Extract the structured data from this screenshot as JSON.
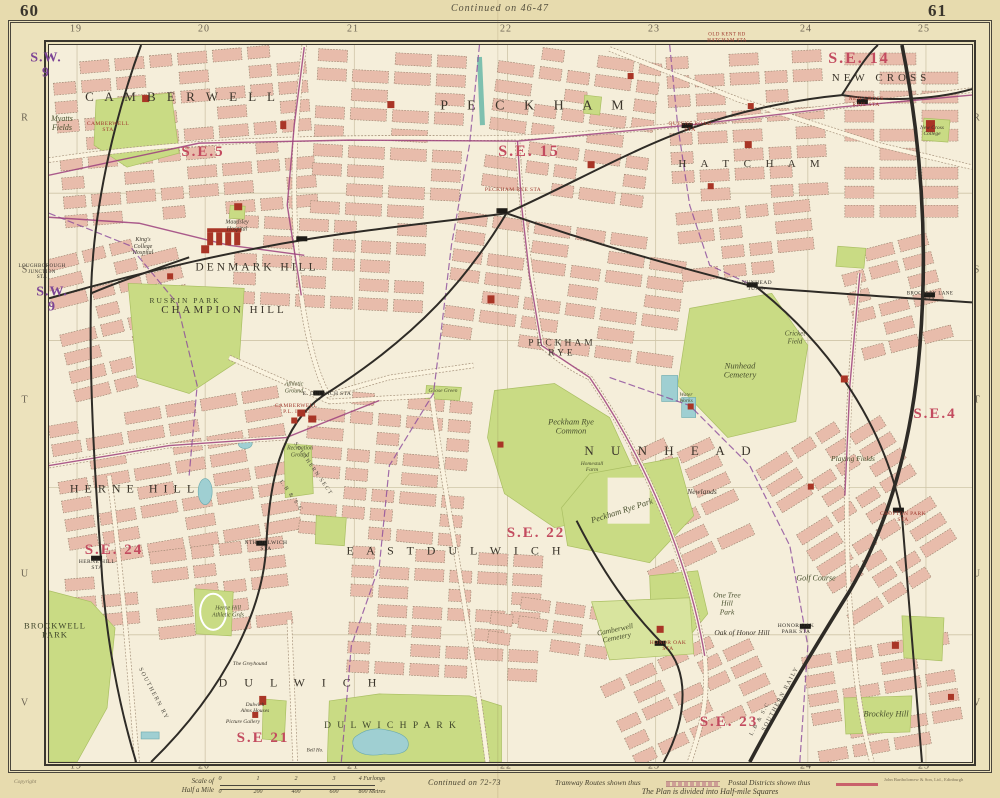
{
  "page": {
    "left_page_no": "60",
    "right_page_no": "61",
    "continued_top": "Continued on  46-47",
    "continued_bottom": "Continued on  72-73",
    "copyright": "Copyright",
    "imprint": "John Bartholomew & Son, Ltd., Edinburgh"
  },
  "grid": {
    "top_numbers": [
      "19",
      "20",
      "21",
      "22",
      "23",
      "24",
      "25"
    ],
    "bottom_numbers": [
      "19",
      "20",
      "21",
      "22",
      "23",
      "24",
      "25"
    ],
    "left_letters": [
      "R",
      "S",
      "T",
      "U",
      "V"
    ],
    "right_letters": [
      "R",
      "S",
      "T",
      "U",
      "V"
    ]
  },
  "legend": {
    "scale_line1": "Scale of",
    "scale_line2": "Half a Mile",
    "furlong_ticks": [
      "0",
      "1",
      "2",
      "3",
      "4 Furlongs"
    ],
    "metre_ticks": [
      "0",
      "200",
      "400",
      "600",
      "800 Metres"
    ],
    "tramway_label": "Tramway Routes shown thus",
    "postal_label": "Postal Districts shown thus",
    "plan_note": "The Plan is divided into Half-mile Squares"
  },
  "colors": {
    "page_bg": "#e7dbae",
    "margin_bg": "#ece2bc",
    "map_bg": "#f5eeda",
    "block": "#e8bcab",
    "block_edge": "#917e68",
    "park": "#c9db84",
    "park_dark": "#aabf63",
    "water": "#9fcfd2",
    "canal": "#7ec0af",
    "rail": "#2e2b26",
    "road": "#faf3df",
    "road_edge": "#a5917a",
    "tram": "#9c3f7d",
    "boundary": "#8b4a9b",
    "postal": "#c34b5f",
    "postal_purple": "#7d4596",
    "red_bldg": "#a93526",
    "district_ink": "#3b352b",
    "sta_red": "#9e372c",
    "frame": "#3a362e",
    "grid": "#cfc5a8",
    "edge_ink": "#6b6353"
  },
  "map_labels": [
    {
      "t": "C A M B E R W E L L",
      "x": 182,
      "y": 97,
      "c": "district",
      "s": 13,
      "ls": 4
    },
    {
      "t": "P E C K H A M",
      "x": 536,
      "y": 106,
      "c": "district",
      "s": 14,
      "ls": 8
    },
    {
      "t": "H A T C H A M",
      "x": 752,
      "y": 164,
      "c": "district",
      "s": 11,
      "ls": 6
    },
    {
      "t": "NEW CROSS",
      "x": 881,
      "y": 78,
      "c": "district",
      "s": 11,
      "ls": 4
    },
    {
      "t": "DENMARK HILL",
      "x": 257,
      "y": 268,
      "c": "district",
      "s": 11.5,
      "ls": 3
    },
    {
      "t": "CHAMPION HILL",
      "x": 224,
      "y": 310,
      "c": "district",
      "s": 11,
      "ls": 3
    },
    {
      "t": "HERNE  HILL",
      "x": 135,
      "y": 489,
      "c": "district",
      "s": 12,
      "ls": 6
    },
    {
      "t": "E A S T   D U L W I C H",
      "x": 456,
      "y": 551,
      "c": "district",
      "s": 12,
      "ls": 5
    },
    {
      "t": "D U L W I C H",
      "x": 301,
      "y": 683,
      "c": "district",
      "s": 12,
      "ls": 7
    },
    {
      "t": "N U N H E A D",
      "x": 671,
      "y": 451,
      "c": "district",
      "s": 13,
      "ls": 7
    },
    {
      "t": "PECKHAM\nRYE",
      "x": 562,
      "y": 349,
      "c": "district",
      "s": 9.5,
      "ls": 3
    },
    {
      "t": "S.E.5",
      "x": 203,
      "y": 152,
      "c": "postal",
      "s": 15
    },
    {
      "t": "S.E. 15",
      "x": 529,
      "y": 152,
      "c": "postal",
      "s": 16
    },
    {
      "t": "S.E. 14",
      "x": 859,
      "y": 59,
      "c": "postal",
      "s": 16
    },
    {
      "t": "S.E.4",
      "x": 935,
      "y": 414,
      "c": "postal",
      "s": 15
    },
    {
      "t": "S.E. 24",
      "x": 114,
      "y": 550,
      "c": "postal",
      "s": 15
    },
    {
      "t": "S.E. 22",
      "x": 536,
      "y": 533,
      "c": "postal",
      "s": 15
    },
    {
      "t": "S.E 21",
      "x": 263,
      "y": 738,
      "c": "postal",
      "s": 15
    },
    {
      "t": "S.E. 23",
      "x": 729,
      "y": 722,
      "c": "postal",
      "s": 15
    },
    {
      "t": "S.W.\n9",
      "x": 46,
      "y": 66,
      "c": "postal-p",
      "s": 14
    },
    {
      "t": "S.W.\n9",
      "x": 52,
      "y": 300,
      "c": "postal-p",
      "s": 14
    },
    {
      "t": "RUSKIN PARK",
      "x": 185,
      "y": 301,
      "c": "park-caps",
      "s": 7.5,
      "ls": 2
    },
    {
      "t": "BROCKWELL\nPARK",
      "x": 55,
      "y": 631,
      "c": "park-caps",
      "s": 8.5,
      "ls": 1
    },
    {
      "t": "D U L W I C H   P A R K",
      "x": 391,
      "y": 726,
      "c": "park-caps",
      "s": 9.5,
      "ls": 2
    },
    {
      "t": "Myatts\nFields",
      "x": 62,
      "y": 124,
      "c": "park",
      "s": 8
    },
    {
      "t": "Peckham Rye\nCommon",
      "x": 571,
      "y": 427,
      "c": "park",
      "s": 8.5
    },
    {
      "t": "Peckham Rye Park",
      "x": 622,
      "y": 511,
      "c": "park",
      "s": 8.5,
      "r": -18
    },
    {
      "t": "Nunhead\nCemetery",
      "x": 740,
      "y": 371,
      "c": "park",
      "s": 8.5
    },
    {
      "t": "One Tree\nHill\nPark",
      "x": 727,
      "y": 604,
      "c": "park",
      "s": 7.5
    },
    {
      "t": "Golf Course",
      "x": 816,
      "y": 579,
      "c": "park",
      "s": 8
    },
    {
      "t": "Camberwell\nCemetery",
      "x": 616,
      "y": 634,
      "c": "park",
      "s": 7.5,
      "r": -12
    },
    {
      "t": "Brockley Hill",
      "x": 886,
      "y": 714,
      "c": "park",
      "s": 8.5
    },
    {
      "t": "Playing Fields",
      "x": 853,
      "y": 459,
      "c": "park",
      "s": 7.5
    },
    {
      "t": "Cricket\nField",
      "x": 795,
      "y": 338,
      "c": "park",
      "s": 7
    },
    {
      "t": "Water\nWorks",
      "x": 686,
      "y": 398,
      "c": "park",
      "s": 5.5
    },
    {
      "t": "Homestall\nFarm",
      "x": 592,
      "y": 467,
      "c": "park",
      "s": 5.5
    },
    {
      "t": "Goose Green",
      "x": 443,
      "y": 391,
      "c": "park",
      "s": 5.5
    },
    {
      "t": "Athletic\nGround",
      "x": 294,
      "y": 388,
      "c": "park",
      "s": 6
    },
    {
      "t": "Recreation\nGround",
      "x": 300,
      "y": 452,
      "c": "park",
      "s": 6
    },
    {
      "t": "Herne Hill\nAthletic Grds",
      "x": 228,
      "y": 612,
      "c": "park",
      "s": 6
    },
    {
      "t": "Oak of Honor Hill",
      "x": 742,
      "y": 633,
      "c": "place",
      "s": 7.5
    },
    {
      "t": "Newlands",
      "x": 702,
      "y": 492,
      "c": "place",
      "s": 7.5
    },
    {
      "t": "King's\nCollege\nHospital",
      "x": 143,
      "y": 247,
      "c": "place",
      "s": 6
    },
    {
      "t": "Maudsley\nHospital",
      "x": 237,
      "y": 226,
      "c": "place",
      "s": 6
    },
    {
      "t": "Dulwich\nAlms Houses",
      "x": 255,
      "y": 708,
      "c": "place",
      "s": 5.5
    },
    {
      "t": "Picture Gallery",
      "x": 243,
      "y": 722,
      "c": "place",
      "s": 5.5
    },
    {
      "t": "The Greyhound",
      "x": 250,
      "y": 664,
      "c": "place",
      "s": 5.5
    },
    {
      "t": "Bell Ho.",
      "x": 315,
      "y": 751,
      "c": "place",
      "s": 5
    },
    {
      "t": "New Cross\nCollege",
      "x": 932,
      "y": 131,
      "c": "place",
      "s": 5.5
    },
    {
      "t": "CAMBERWELL\nSTA",
      "x": 108,
      "y": 127,
      "c": "sta",
      "s": 5.5
    },
    {
      "t": "PECKHAM RYE STA",
      "x": 513,
      "y": 190,
      "c": "sta",
      "s": 5.5
    },
    {
      "t": "QUEENS ROAD\nSTA",
      "x": 690,
      "y": 127,
      "c": "sta",
      "s": 5.5
    },
    {
      "t": "NEW CROSS\nRAIL STA",
      "x": 866,
      "y": 102,
      "c": "sta",
      "s": 5.5
    },
    {
      "t": "OLD KENT RD\nHATCHAM STA",
      "x": 727,
      "y": 38,
      "c": "sta",
      "s": 5
    },
    {
      "t": "CROFTON PARK\nSTA",
      "x": 903,
      "y": 517,
      "c": "sta",
      "s": 5.5
    },
    {
      "t": "HONOR OAK\nSTA",
      "x": 668,
      "y": 646,
      "c": "sta",
      "s": 5.5
    },
    {
      "t": "CAMBERWELL\nP.L. INST",
      "x": 296,
      "y": 409,
      "c": "sta",
      "s": 5.5
    },
    {
      "t": "LOUGHBOROUGH\nJUNCTION\nSTA",
      "x": 42,
      "y": 272,
      "c": "sta-k",
      "s": 5
    },
    {
      "t": "NUNHEAD\nJUNC.",
      "x": 757,
      "y": 286,
      "c": "sta-k",
      "s": 5.5
    },
    {
      "t": "BROCKLEY LANE\nSTA",
      "x": 930,
      "y": 297,
      "c": "sta-k",
      "s": 5
    },
    {
      "t": "HERNE HILL\nSTA",
      "x": 97,
      "y": 565,
      "c": "sta-k",
      "s": 5.5
    },
    {
      "t": "NTH DULWICH\nSTA",
      "x": 266,
      "y": 546,
      "c": "sta-k",
      "s": 5.5
    },
    {
      "t": "E. DULWICH STA",
      "x": 327,
      "y": 394,
      "c": "sta-k",
      "s": 5.5
    },
    {
      "t": "HONOR OAK\nPARK STA",
      "x": 796,
      "y": 629,
      "c": "sta-k",
      "s": 5.5
    },
    {
      "t": "SOUTHERN RY",
      "x": 153,
      "y": 694,
      "c": "rail",
      "s": 6,
      "r": 62
    },
    {
      "t": "L.B & S.C",
      "x": 291,
      "y": 496,
      "c": "rail",
      "s": 5.5,
      "r": 55
    },
    {
      "t": "SOUTHERN SECT",
      "x": 313,
      "y": 469,
      "c": "rail",
      "s": 5.5,
      "r": 55
    },
    {
      "t": "L.B & S.C",
      "x": 760,
      "y": 719,
      "c": "rail",
      "s": 5.5,
      "r": -62
    },
    {
      "t": "SOUTHERN RAILY",
      "x": 781,
      "y": 699,
      "c": "rail",
      "s": 6,
      "r": -62
    }
  ]
}
